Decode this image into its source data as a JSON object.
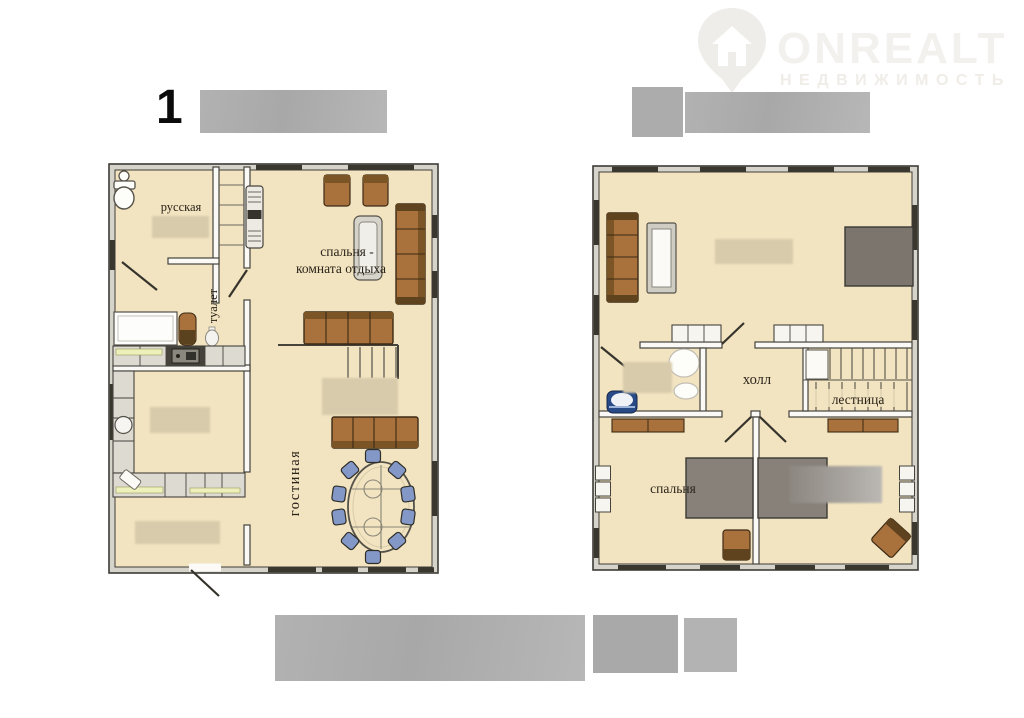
{
  "watermark": {
    "brand": "ONREALT",
    "subtitle": "НЕДВИЖИМОСТЬ"
  },
  "plan_header": {
    "floor1_number": "1"
  },
  "floor1": {
    "labels": {
      "sauna": "русская",
      "toilet": "туалет",
      "bedroom_rest_line1": "спальня -",
      "bedroom_rest_line2": "комната отдыха",
      "living_room": "гостиная"
    }
  },
  "floor2": {
    "labels": {
      "hall": "холл",
      "staircase": "лестница",
      "bedroom": "спальня"
    }
  },
  "colors": {
    "floor_fill": "#f2e4c0",
    "wall_dark": "#3e3c36",
    "wood_brown": "#a9713c",
    "chair_blue": "#8398c6",
    "bed_gray": "#87817a",
    "redacted_gray": "#aeaeae",
    "redacted_beige": "#d8cbab",
    "watermark_gray": "#f0eeeb"
  }
}
